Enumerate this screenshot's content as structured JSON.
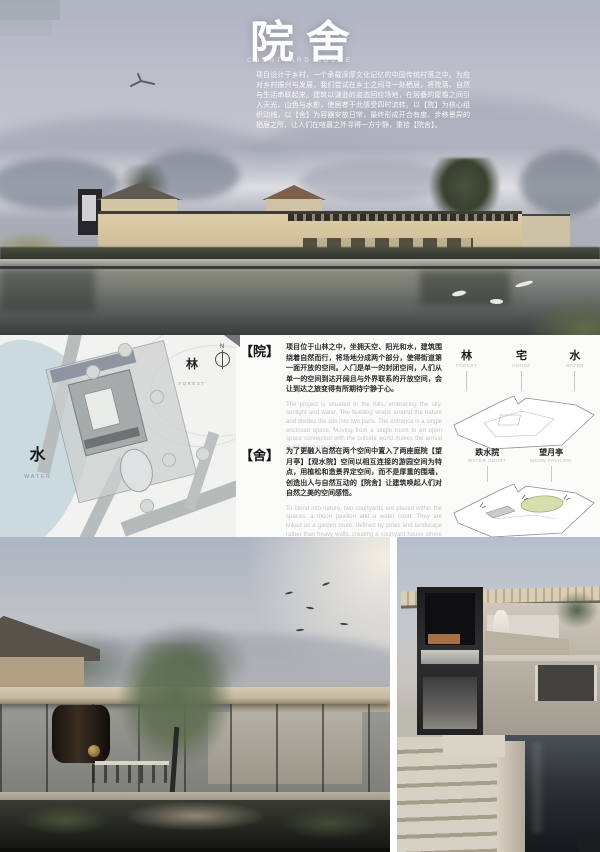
{
  "hero": {
    "title": "院舍",
    "subtitle": "COURTYARD HOUSE",
    "description": "项目设计于乡村，一个承载深厚文化记忆的中国传统村落之中。为应对乡村振兴与发展，我们尝试在乡土之间寻一处栖居，将院落、自然与生活串联起来。建筑以谦逊的姿态回应场地，在层叠的屋檐之间引入天光、山色与水影，使居者于此感受四时流转。以【院】为核心组织动线，以【舍】为容器安放日常，最终形成开合有度、步移景异的栖居之所，让人们在喧嚣之外寻得一方宁静，重拾【院舍】。"
  },
  "siteplan": {
    "water_cn": "水",
    "water_en": "WATER",
    "forest_cn": "林",
    "forest_en": "FOREST",
    "north": "N"
  },
  "concept": {
    "yuan": {
      "tag": "【院】",
      "cn": "项目位于山林之中，坐拥天空、阳光和水，建筑围绕着自然而行，将场地分成两个部分，使得街道第一面开放的空间。入门是单一的封闭空间，人们从单一的空间到达开阔且与外界联系的开放空间，会让到达之旅变得有所期待宁静于心。",
      "en": "The project is situated in the hills, embracing the sky, sunlight and water. The building wraps around the nature and divides the site into two parts. The entrance is a single enclosed space. Moving from a single room to an open space connected with the outside world makes the arrival quiet and expected."
    },
    "she": {
      "tag": "【舍】",
      "cn": "为了更融入自然在两个空间中置入了两座庭院【望月亭】【观水院】空间以相互连接的游园空间为特点，用植松和造景界定空间，而不是厚重的围墙，创造出人与自然互动的【院舍】让建筑唤起人们对自然之美的空间感悟。",
      "en": "To blend into nature, two courtyards are placed within the spaces: a moon pavilion and a water court. They are linked as a garden route, defined by pines and landscape rather than heavy walls, creating a courtyard house where architecture evokes the beauty of nature."
    }
  },
  "diagram_top": {
    "labels": [
      {
        "cn": "林",
        "en": "FOREST"
      },
      {
        "cn": "宅",
        "en": "HOUSE"
      },
      {
        "cn": "水",
        "en": "WATER"
      }
    ]
  },
  "diagram_bottom": {
    "labels": [
      {
        "cn": "跌水院",
        "en": "WATER COURT"
      },
      {
        "cn": "望月亭",
        "en": "MOON PAVILION"
      }
    ]
  },
  "colors": {
    "building_beige": "#d8c8a4",
    "plan_water_blue": "#cbdade",
    "pond_green": "#d6dfad",
    "text_dark": "#2a2a2a",
    "text_gray": "#c4c7c9"
  }
}
